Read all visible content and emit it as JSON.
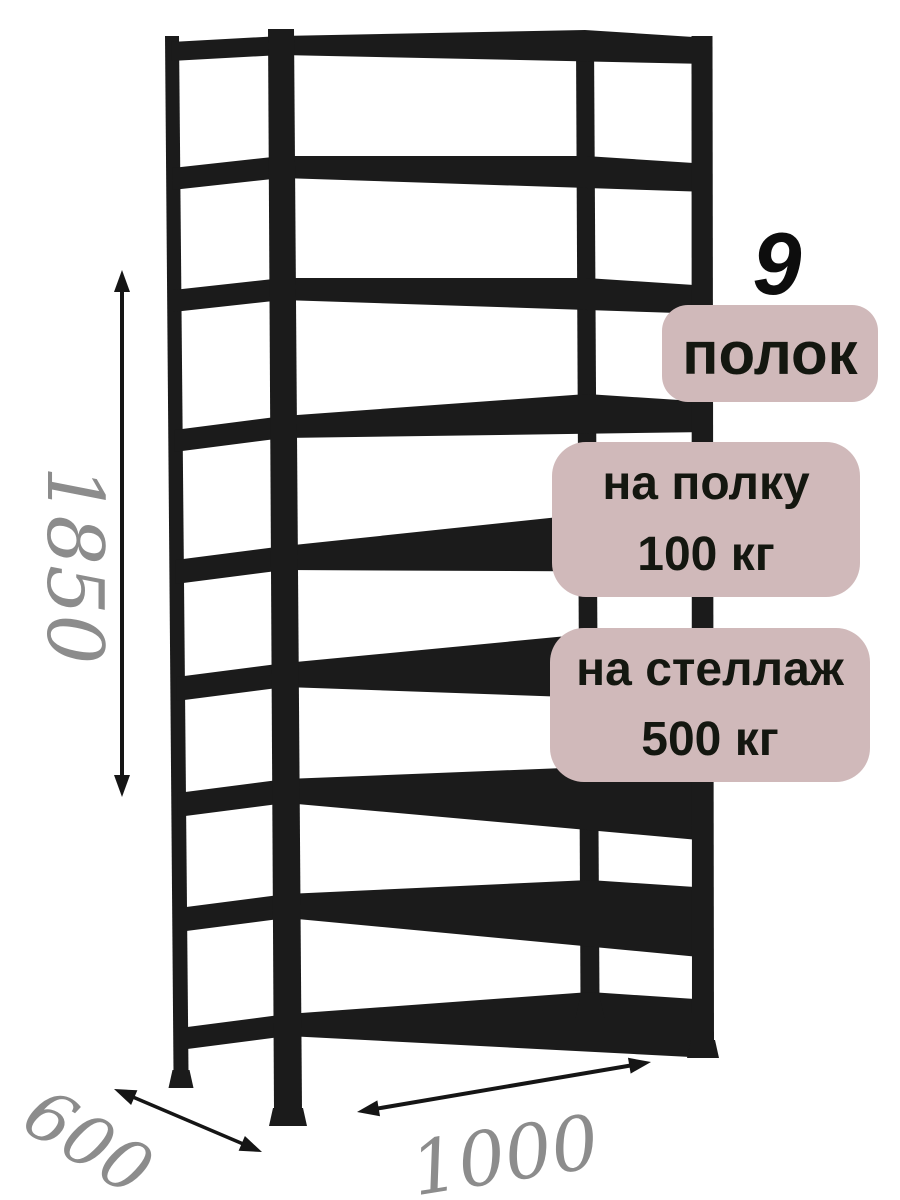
{
  "product": {
    "shelf_count": "9",
    "shelf_count_unit": "полок",
    "shelf_load_line1": "на полку",
    "shelf_load_line2": "100 кг",
    "rack_load_line1": "на стеллаж",
    "rack_load_line2": "500 кг"
  },
  "dimensions": {
    "height": "1850",
    "depth": "600",
    "width": "1000"
  },
  "colors": {
    "background": "#ffffff",
    "rack": "#1b1b1b",
    "badge_background": "#d0b9ba",
    "badge_text": "#141710",
    "count_text": "#0d0d0d",
    "dimension_text": "#8c8c8c",
    "arrow": "#151515"
  }
}
